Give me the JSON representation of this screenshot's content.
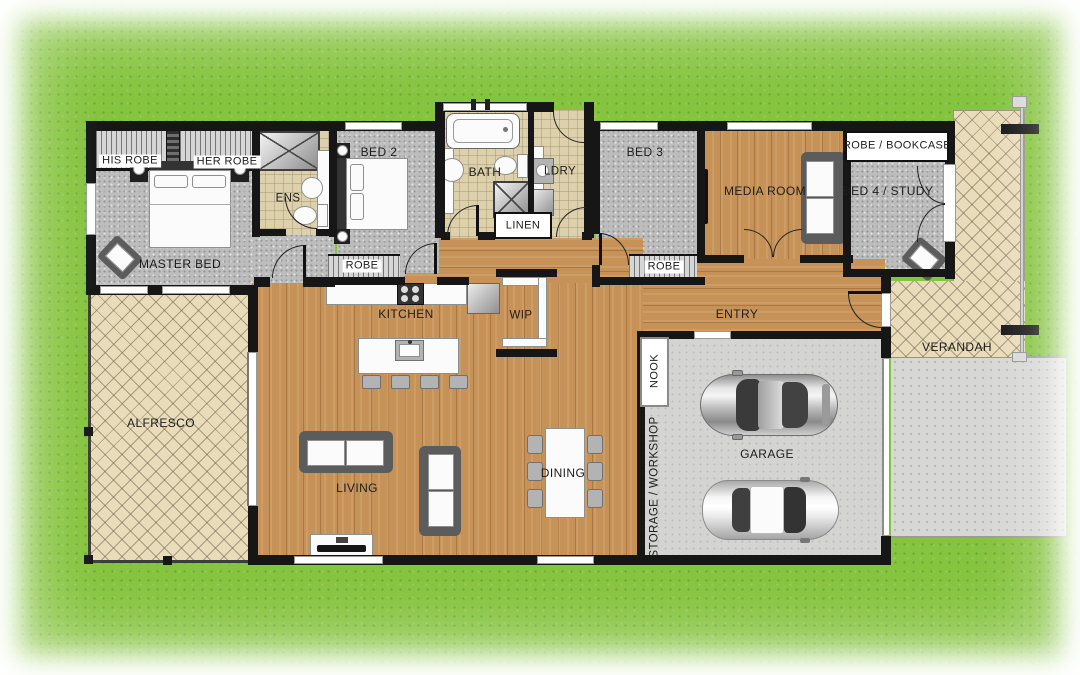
{
  "colors": {
    "grass": "#85c43e",
    "wood": "#c79257",
    "carpet": "#bdbdbd",
    "tile": "#ddd1ad",
    "paving": "#e9dcba",
    "garage": "#d4d4d2",
    "driveway": "#d7d7d5",
    "wall": "#161616"
  },
  "rooms": {
    "his_robe": "HIS ROBE",
    "her_robe": "HER ROBE",
    "master_bed": "MASTER BED",
    "ens": "ENS",
    "bed2": "BED 2",
    "bath": "BATH",
    "ldry": "LDRY",
    "linen": "LINEN",
    "bed3": "BED 3",
    "media": "MEDIA ROOM",
    "bed4": "BED 4 / STUDY",
    "robe_bookcase": "ROBE / BOOKCASE",
    "robe2": "ROBE",
    "robe3": "ROBE",
    "kitchen": "KITCHEN",
    "wip": "WIP",
    "entry": "ENTRY",
    "nook": "NOOK",
    "storage": "STORAGE / WORKSHOP",
    "garage": "GARAGE",
    "dining": "DINING",
    "living": "LIVING",
    "alfresco": "ALFRESCO",
    "verandah": "VERANDAH"
  }
}
